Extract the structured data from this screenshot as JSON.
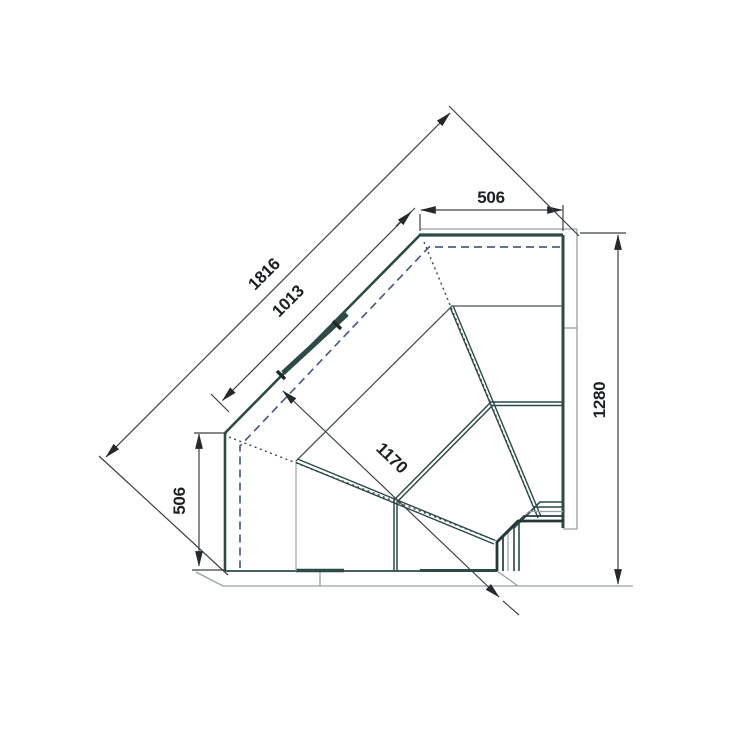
{
  "drawing": {
    "description": "Plan view technical drawing of a 90-degree internal corner display counter",
    "view": "top plan",
    "background": "#ffffff"
  },
  "dimensions": {
    "top_width": {
      "value": "506"
    },
    "diagonal_overall": {
      "value": "1816"
    },
    "diagonal_front": {
      "value": "1013"
    },
    "left_depth": {
      "value": "506"
    },
    "corner_diagonal": {
      "value": "1170"
    },
    "right_depth": {
      "value": "1280"
    }
  },
  "colors": {
    "case_edge_teal": "#2c4a46",
    "dimension_line": "#3c4144",
    "thin_outline_gray": "#97a1a5",
    "hidden_work_line_blue": "#4d5b8f",
    "label_text": "#1c2022"
  }
}
